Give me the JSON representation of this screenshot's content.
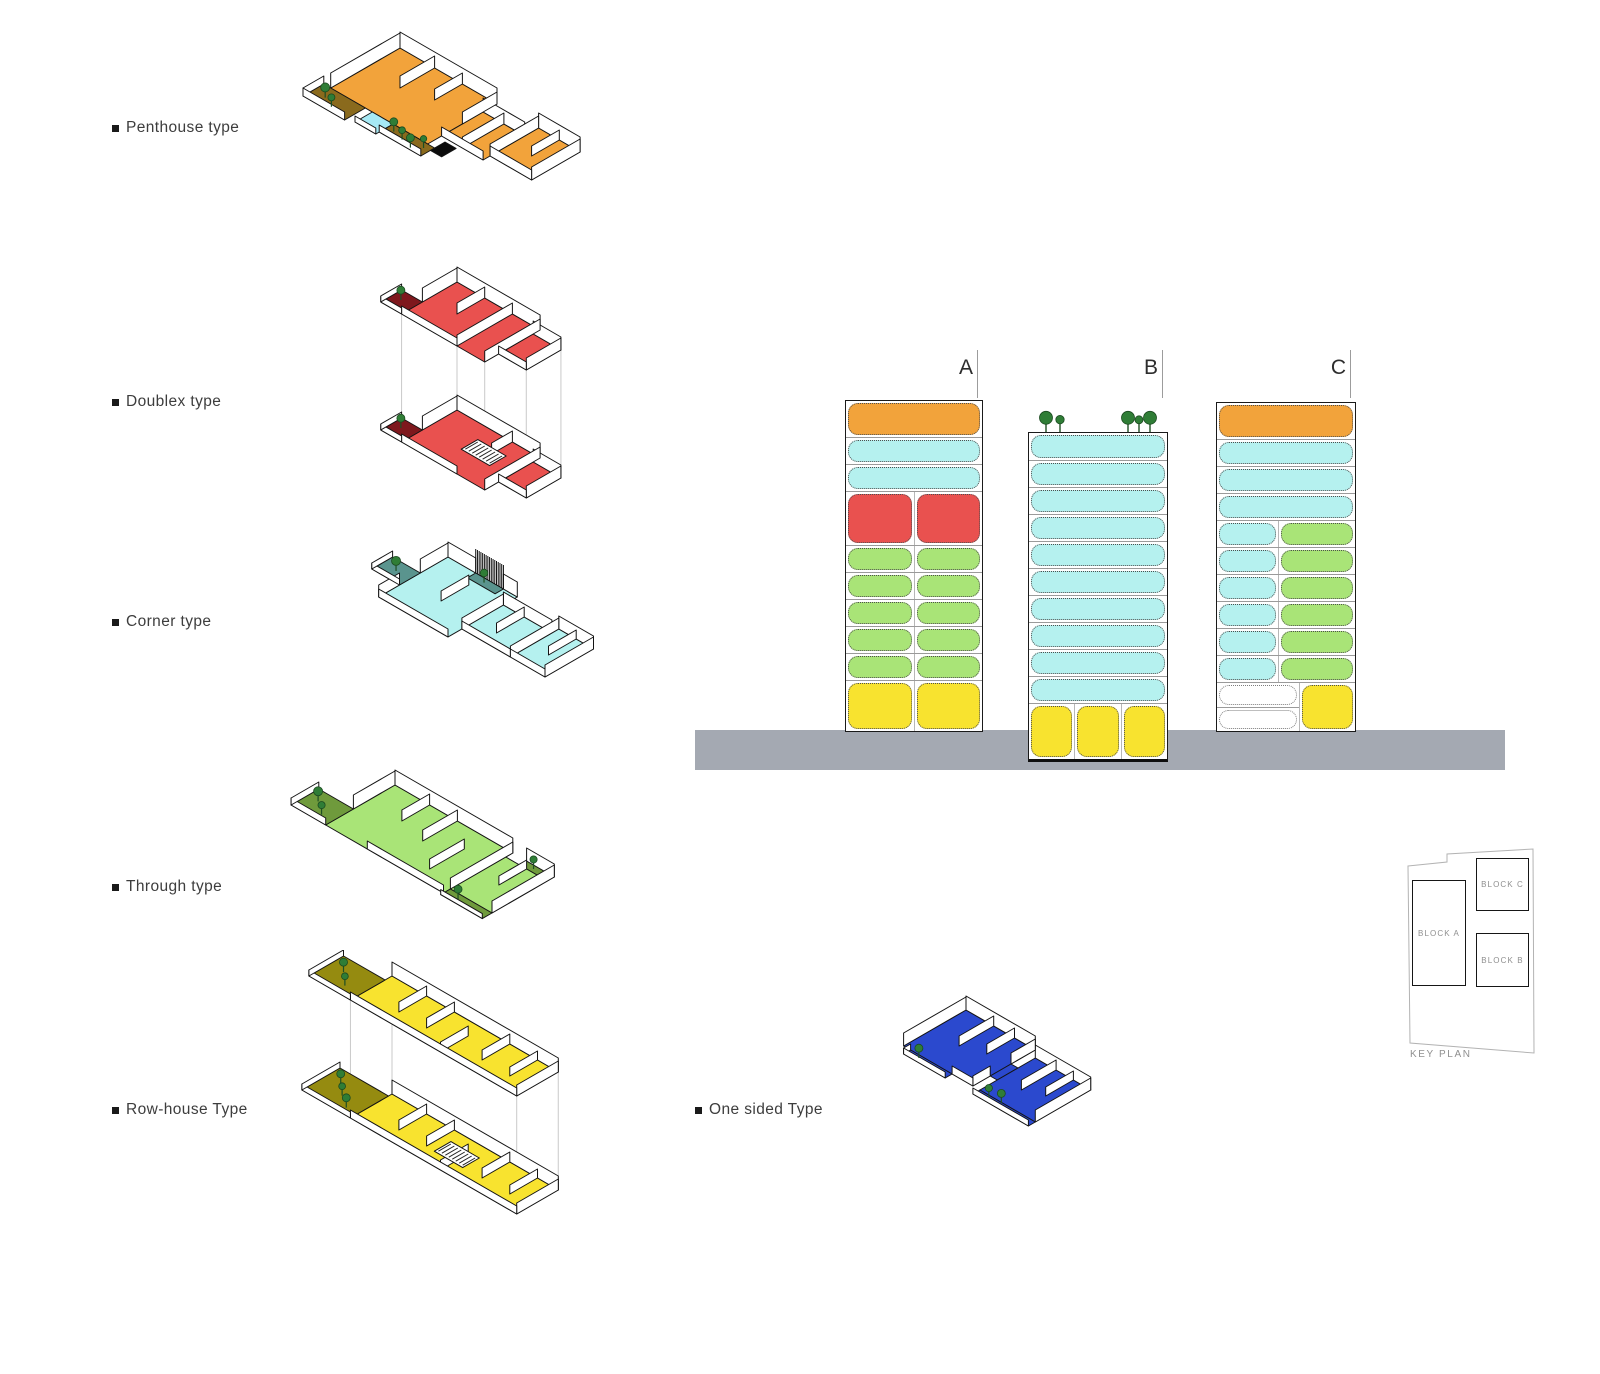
{
  "legend": {
    "items": [
      {
        "label": "Penthouse type"
      },
      {
        "label": "Doublex type"
      },
      {
        "label": "Corner type"
      },
      {
        "label": "Through type"
      },
      {
        "label": "Row-house Type"
      },
      {
        "label": "One sided Type"
      }
    ]
  },
  "colors": {
    "penthouse_orange": "#F2A33B",
    "doublex_red": "#E9514F",
    "corner_cyan": "#B5F1EF",
    "through_green": "#A9E477",
    "rowhouse_yellow": "#F8E32F",
    "onesided_blue": "#2B49CE",
    "terrace_brown": "#8A6A1D",
    "balcony_darkred": "#7E181D",
    "balcony_teal": "#5A948E",
    "terrace_olive": "#6F9A3C",
    "terrace_darkyellow": "#958B10",
    "tree_green": "#2F7D36",
    "pool_cyan": "#A6E9F5",
    "ground_gray": "#A4A9B2",
    "empty_white": "#FFFFFF"
  },
  "elevation": {
    "towers": [
      {
        "label": "A",
        "rows": [
          {
            "h": 36,
            "cells": [
              {
                "c": "penthouse_orange",
                "w": 1
              }
            ]
          },
          {
            "h": 27,
            "cells": [
              {
                "c": "corner_cyan",
                "w": 1
              }
            ]
          },
          {
            "h": 27,
            "cells": [
              {
                "c": "corner_cyan",
                "w": 1
              }
            ]
          },
          {
            "h": 54,
            "cells": [
              {
                "c": "doublex_red",
                "w": 1
              },
              {
                "c": "doublex_red",
                "w": 1
              }
            ]
          },
          {
            "h": 27,
            "cells": [
              {
                "c": "through_green",
                "w": 1
              },
              {
                "c": "through_green",
                "w": 1
              }
            ]
          },
          {
            "h": 27,
            "cells": [
              {
                "c": "through_green",
                "w": 1
              },
              {
                "c": "through_green",
                "w": 1
              }
            ]
          },
          {
            "h": 27,
            "cells": [
              {
                "c": "through_green",
                "w": 1
              },
              {
                "c": "through_green",
                "w": 1
              }
            ]
          },
          {
            "h": 27,
            "cells": [
              {
                "c": "through_green",
                "w": 1
              },
              {
                "c": "through_green",
                "w": 1
              }
            ]
          },
          {
            "h": 27,
            "cells": [
              {
                "c": "through_green",
                "w": 1
              },
              {
                "c": "through_green",
                "w": 1
              }
            ]
          },
          {
            "h": 51,
            "cells": [
              {
                "c": "rowhouse_yellow",
                "w": 1
              },
              {
                "c": "rowhouse_yellow",
                "w": 1
              }
            ]
          }
        ]
      },
      {
        "label": "B",
        "rows": [
          {
            "h": 27,
            "cells": [
              {
                "c": "corner_cyan",
                "w": 1
              }
            ]
          },
          {
            "h": 27,
            "cells": [
              {
                "c": "corner_cyan",
                "w": 1
              }
            ]
          },
          {
            "h": 27,
            "cells": [
              {
                "c": "corner_cyan",
                "w": 1
              }
            ]
          },
          {
            "h": 27,
            "cells": [
              {
                "c": "corner_cyan",
                "w": 1
              }
            ]
          },
          {
            "h": 27,
            "cells": [
              {
                "c": "corner_cyan",
                "w": 1
              }
            ]
          },
          {
            "h": 27,
            "cells": [
              {
                "c": "corner_cyan",
                "w": 1
              }
            ]
          },
          {
            "h": 27,
            "cells": [
              {
                "c": "corner_cyan",
                "w": 1
              }
            ]
          },
          {
            "h": 27,
            "cells": [
              {
                "c": "corner_cyan",
                "w": 1
              }
            ]
          },
          {
            "h": 27,
            "cells": [
              {
                "c": "corner_cyan",
                "w": 1
              }
            ]
          },
          {
            "h": 27,
            "cells": [
              {
                "c": "corner_cyan",
                "w": 1
              }
            ]
          },
          {
            "h": 56,
            "cells": [
              {
                "c": "rowhouse_yellow",
                "w": 1
              },
              {
                "c": "rowhouse_yellow",
                "w": 1
              },
              {
                "c": "rowhouse_yellow",
                "w": 1
              }
            ]
          }
        ]
      },
      {
        "label": "C",
        "rows": [
          {
            "h": 36,
            "cells": [
              {
                "c": "penthouse_orange",
                "w": 1
              }
            ]
          },
          {
            "h": 27,
            "cells": [
              {
                "c": "corner_cyan",
                "w": 1
              }
            ]
          },
          {
            "h": 27,
            "cells": [
              {
                "c": "corner_cyan",
                "w": 1
              }
            ]
          },
          {
            "h": 27,
            "cells": [
              {
                "c": "corner_cyan",
                "w": 1
              }
            ]
          },
          {
            "h": 27,
            "cells": [
              {
                "c": "corner_cyan",
                "w": 0.44
              },
              {
                "c": "through_green",
                "w": 0.56
              }
            ]
          },
          {
            "h": 27,
            "cells": [
              {
                "c": "corner_cyan",
                "w": 0.44
              },
              {
                "c": "through_green",
                "w": 0.56
              }
            ]
          },
          {
            "h": 27,
            "cells": [
              {
                "c": "corner_cyan",
                "w": 0.44
              },
              {
                "c": "through_green",
                "w": 0.56
              }
            ]
          },
          {
            "h": 27,
            "cells": [
              {
                "c": "corner_cyan",
                "w": 0.44
              },
              {
                "c": "through_green",
                "w": 0.56
              }
            ]
          },
          {
            "h": 27,
            "cells": [
              {
                "c": "corner_cyan",
                "w": 0.44
              },
              {
                "c": "through_green",
                "w": 0.56
              }
            ]
          },
          {
            "h": 27,
            "cells": [
              {
                "c": "corner_cyan",
                "w": 0.44
              },
              {
                "c": "through_green",
                "w": 0.56
              }
            ]
          },
          {
            "h": 49,
            "custom": "split_bottom",
            "left_cells": 2,
            "left_color": "empty_white",
            "right_color": "rowhouse_yellow",
            "left_flex": 0.62,
            "right_flex": 0.38
          }
        ]
      }
    ]
  },
  "key_plan": {
    "title": "KEY PLAN",
    "blocks": [
      {
        "label": "BLOCK A"
      },
      {
        "label": "BLOCK C"
      },
      {
        "label": "BLOCK B"
      }
    ]
  }
}
